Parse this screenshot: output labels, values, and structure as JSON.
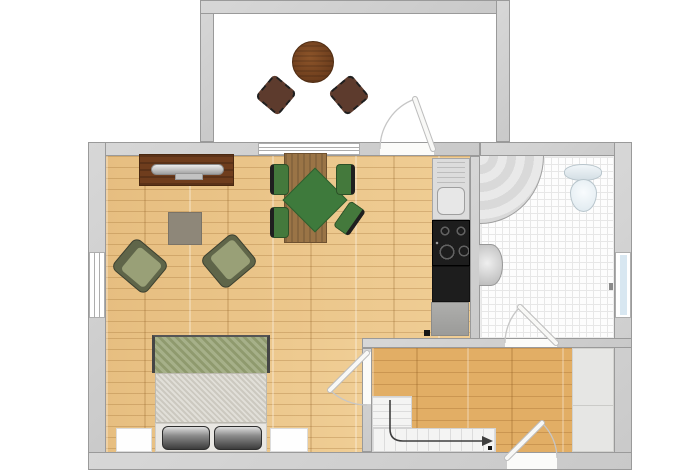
{
  "title": "studio-apartment-floor-plan",
  "rooms": [
    {
      "id": "balcony",
      "kind": "balcony"
    },
    {
      "id": "living-area",
      "kind": "combined-living-dining-sleeping"
    },
    {
      "id": "kitchen-strip",
      "kind": "kitchenette"
    },
    {
      "id": "bathroom",
      "kind": "tiled-bathroom"
    },
    {
      "id": "hallway",
      "kind": "entry-hall-with-staircase"
    },
    {
      "id": "closet",
      "kind": "built-in-closet"
    }
  ],
  "furniture": [
    "balcony-round-table",
    "wicker-chair-left",
    "wicker-chair-right",
    "sideboard",
    "tv-on-sideboard",
    "side-table",
    "armchair-left",
    "armchair-right",
    "dining-table",
    "green-rug",
    "dining-chair-1",
    "dining-chair-2",
    "dining-chair-3",
    "dining-chair-4",
    "double-bed",
    "pillow-left",
    "pillow-right",
    "nightstand-left",
    "nightstand-right",
    "kitchen-sink-unit",
    "cooktop-4-burners",
    "kitchen-counter",
    "kitchen-cabinet",
    "corner-shower",
    "toilet",
    "wash-basin",
    "l-shaped-staircase",
    "stair-direction-arrow"
  ],
  "doors": [
    "balcony-door",
    "bathroom-door",
    "living-hall-door",
    "entry-door"
  ],
  "windows": [
    "living-top-window",
    "living-left-window",
    "bathroom-window"
  ],
  "colors": {
    "wall": "#c9c9c9",
    "wallEdge": "#9a9a9a",
    "balconyFloor": "#ffffff",
    "livingFloor": "#ecc78c",
    "hallFloor": "#e2ae65",
    "tileFloor": "#fdfdfd",
    "tileLine": "#e7e7e7",
    "closet": "#e6e6e4",
    "sideboard": "#6f3d1d",
    "diningTable": "#9a7446",
    "rug": "#3e7a3c",
    "chairGreen": "#44793c",
    "chairBack": "#1f1f1f",
    "armchairBody": "#5f6549",
    "armchairSeat": "#99a077",
    "sideTable": "#8e8779",
    "bedBlanket": "#97a274",
    "bedMattress": "#d4d1c8",
    "bedBase": "#e9e7e3",
    "nightstand": "#fefefe",
    "counterDark": "#1d1d1d",
    "sinkUnit": "#dcdcdc",
    "balconyTable": "#6b3c1c",
    "wicker": "#5d3b2d",
    "stair": "#f4f4f3",
    "stairLine": "#dcdcdc",
    "arrow": "#3f3f3f",
    "windowFrame": "#adadad",
    "windowBlue": "#d8e7f1"
  }
}
